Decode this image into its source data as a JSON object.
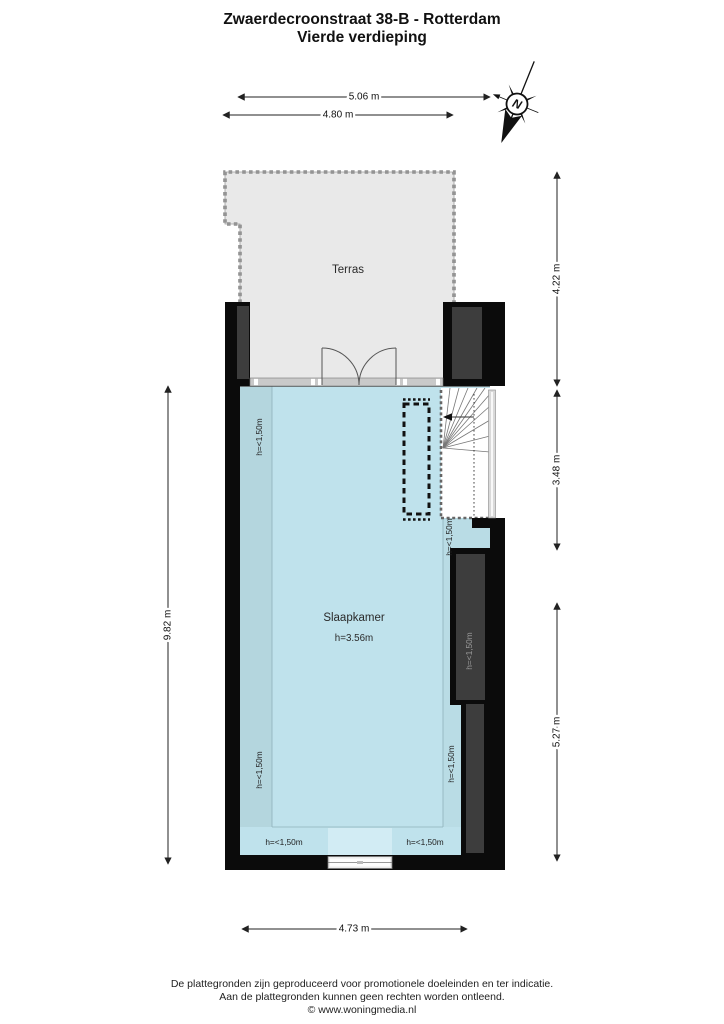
{
  "title": {
    "line1": "Zwaerdecroonstraat 38-B - Rotterdam",
    "line2": "Vierde verdieping"
  },
  "compass": {
    "north_label": "N"
  },
  "rooms": {
    "terras": {
      "label": "Terras"
    },
    "slaapkamer": {
      "label": "Slaapkamer",
      "ceiling_height": "h=3.56m"
    }
  },
  "dimensions": {
    "terrace_width_outer": "5.06 m",
    "terrace_width_inner": "4.80 m",
    "terrace_depth": "4.22 m",
    "stair_section_depth": "3.48 m",
    "lower_section_depth": "5.27 m",
    "total_depth": "9.82 m",
    "room_width": "4.73 m"
  },
  "labels": {
    "low_clearance": "h=<1,50m"
  },
  "footer": {
    "line1": "De plattegronden zijn geproduceerd voor promotionele doeleinden en ter indicatie.",
    "line2": "Aan de plattegronden kunnen geen rechten worden ontleend.",
    "line3": "© www.woningmedia.nl"
  },
  "colors": {
    "room_fill": "#bfe2ec",
    "room_low_left": "#b4d6de",
    "room_low_right": "#b9dce5",
    "window_patch": "#d2ecf4",
    "terrace_fill": "#e9e9e9",
    "wall": "#0b0b0b",
    "wall_inset": "#3d3d3d"
  }
}
